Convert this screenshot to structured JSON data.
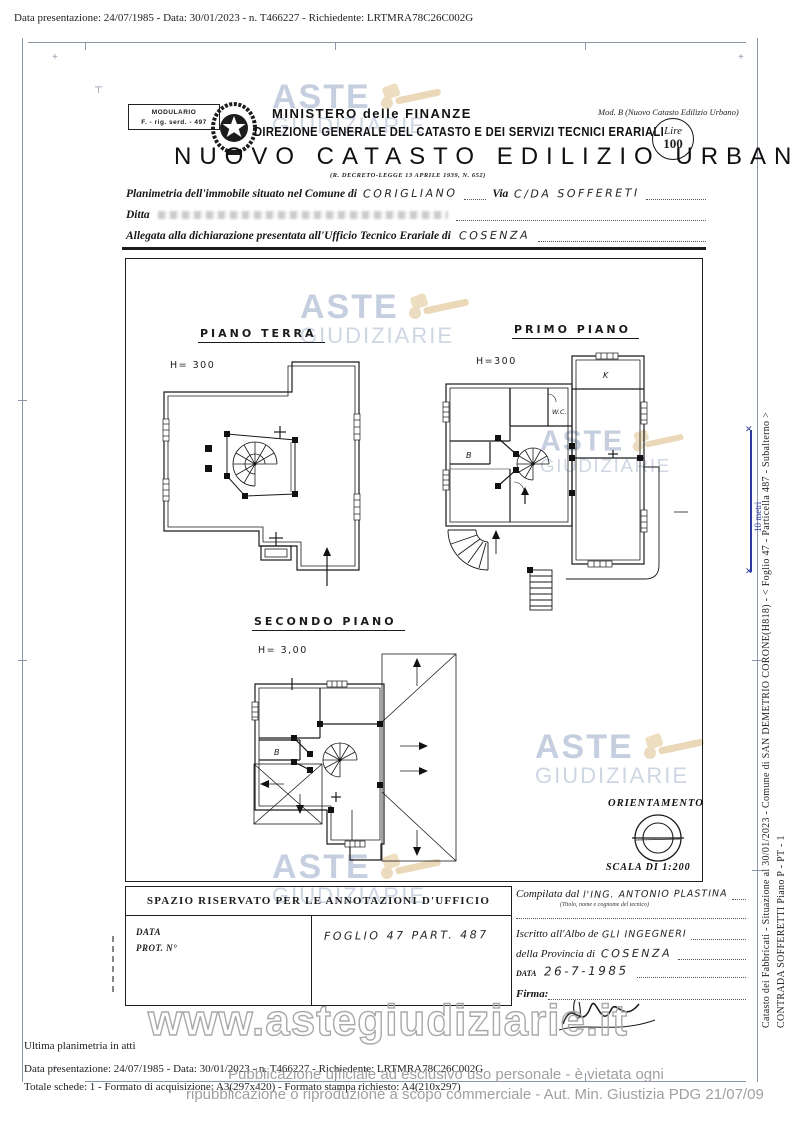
{
  "meta": {
    "top_line": "Data presentazione: 24/07/1985 - Data: 30/01/2023 - n. T466227 - Richiedente: LRTMRA78C26C002G"
  },
  "header": {
    "modulario_top": "MODULARIO",
    "modulario_bottom": "F. - rig. serd. - 497",
    "mod_b": "Mod. B (Nuovo Catasto Edilizio Urbano)",
    "ministero": "MINISTERO delle FINANZE",
    "direzione": "DIREZIONE GENERALE DEL CATASTO E DEI SERVIZI TECNICI ERARIALI",
    "title": "NUOVO CATASTO EDILIZIO URBANO",
    "decreto": "(R. DECRETO-LEGGE 13 APRILE 1939, N. 652)",
    "lire_label": "Lire",
    "lire_value": "100"
  },
  "form": {
    "planimetria_label": "Planimetria dell'immobile situato nel Comune di",
    "comune_value": "CORIGLIANO",
    "via_label": "Via",
    "via_value": "C/DA SOFFERETI",
    "ditta_label": "Ditta",
    "allegata_label": "Allegata alla dichiarazione presentata all'Ufficio Tecnico Erariale di",
    "ufficio_value": "COSENZA"
  },
  "plans": {
    "piano_terra_label": "PIANO TERRA",
    "piano_terra_h": "H= 300",
    "primo_piano_label": "PRIMO PIANO",
    "primo_piano_h": "H=300",
    "secondo_piano_label": "SECONDO PIANO",
    "secondo_piano_h": "H= 3,00",
    "room_k": "K",
    "room_wc": "W.C.",
    "room_b": "B",
    "orientamento_label": "ORIENTAMENTO",
    "scala_label": "SCALA DI 1:200"
  },
  "office": {
    "header": "SPAZIO RISERVATO PER LE ANNOTAZIONI D'UFFICIO",
    "data_label": "DATA",
    "prot_label": "PROT. N°",
    "foglio_value": "FOGLIO 47    PART. 487"
  },
  "tecnico": {
    "compilata_label": "Compilata dal",
    "compilata_value": "l'ING. ANTONIO PLASTINA",
    "titolo_note": "(Titolo, nome e cognome del tecnico)",
    "iscritto_label": "Iscritto all'Albo de",
    "iscritto_value": "GLI INGEGNERI",
    "provincia_label": "della Provincia di",
    "provincia_value": "COSENZA",
    "data_label": "DATA",
    "data_value": "26-7-1985",
    "firma_label": "Firma:"
  },
  "watermark": {
    "aste": "ASTE",
    "giudiziarie": "GIUDIZIARIE",
    "url": "www.astegiudiziarie.it"
  },
  "sidebar": {
    "catasto_line": "Catasto dei Fabbricati - Situazione al 30/01/2023 - Comune di SAN DEMETRIO CORONE(H818) - < Foglio 47 - Particella 487 - Subalterno >",
    "contrada_line": "CONTRADA SOFFERETTI Piano P - PT - 1",
    "scale_label": "10 metri"
  },
  "footer": {
    "ultima": "Ultima planimetria in atti",
    "meta_line": "Data presentazione: 24/07/1985 - Data: 30/01/2023 - n. T466227 - Richiedente: LRTMRA78C26C002G",
    "schede_line": "Totale schede: 1 - Formato di acquisizione: A3(297x420) - Formato stampa richiesto: A4(210x297)",
    "legal1": "Pubblicazione ufficiale ad esclusivo uso personale - è vietata ogni",
    "legal2": "ripubblicazione o riproduzione a scopo commerciale - Aut. Min. Giustizia PDG 21/07/09"
  },
  "colors": {
    "watermark_blue": "#bdc7da",
    "gavel_tan": "#e9d6b4",
    "scale_blue": "#2b3a9c",
    "ink": "#1d1d1d"
  }
}
